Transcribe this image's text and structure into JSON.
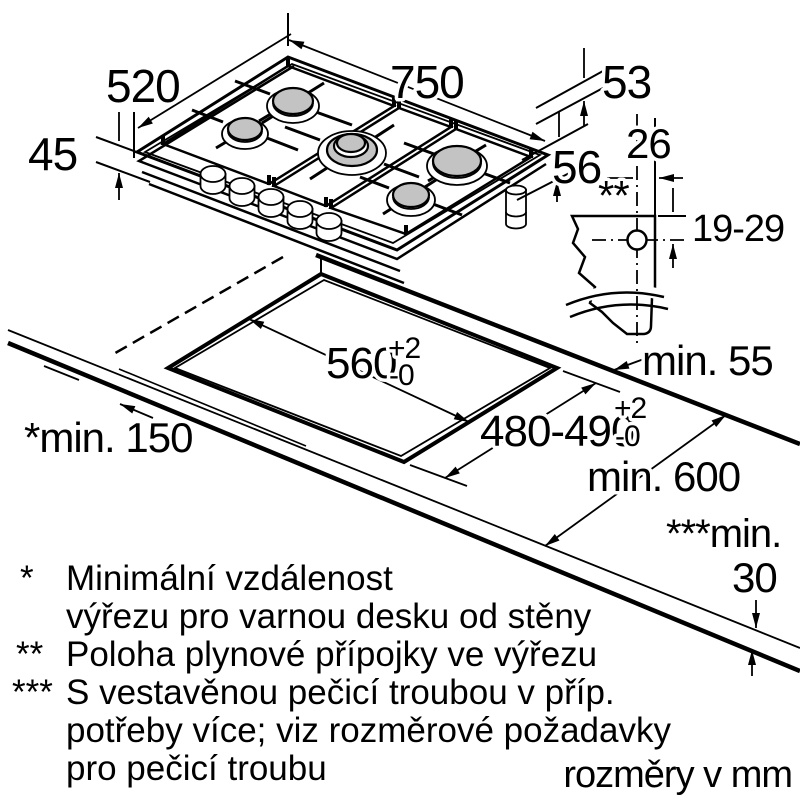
{
  "units_note": "rozměry v mm",
  "dims": {
    "width": "750",
    "depth": "520",
    "height": "45",
    "d53": "53",
    "d56": "56",
    "d26": "26",
    "d19_29": "19-29",
    "gas_marker": "**",
    "min55": "min. 55",
    "min600": "min. 600",
    "min150": "*min. 150",
    "min30_label": "***min.",
    "min30_value": "30",
    "cutout_width": "560",
    "cutout_width_tol_plus": "+2",
    "cutout_width_tol_minus": "-0",
    "cutout_depth": "480-490",
    "cutout_depth_tol_plus": "+2",
    "cutout_depth_tol_minus": "-0"
  },
  "legend": {
    "items": [
      {
        "marker": "*",
        "lines": [
          "Minimální vzdálenost",
          "výřezu pro varnou desku od stěny"
        ]
      },
      {
        "marker": "**",
        "lines": [
          "Poloha plynové přípojky ve výřezu"
        ]
      },
      {
        "marker": "***",
        "lines": [
          "S vestavěnou pečicí troubou v příp.",
          "potřeby více; viz rozměrové požadavky",
          "pro pečicí troubu"
        ]
      }
    ]
  },
  "colors": {
    "line": "#000000",
    "burner_fill": "#c3c3c3",
    "background": "#ffffff"
  }
}
